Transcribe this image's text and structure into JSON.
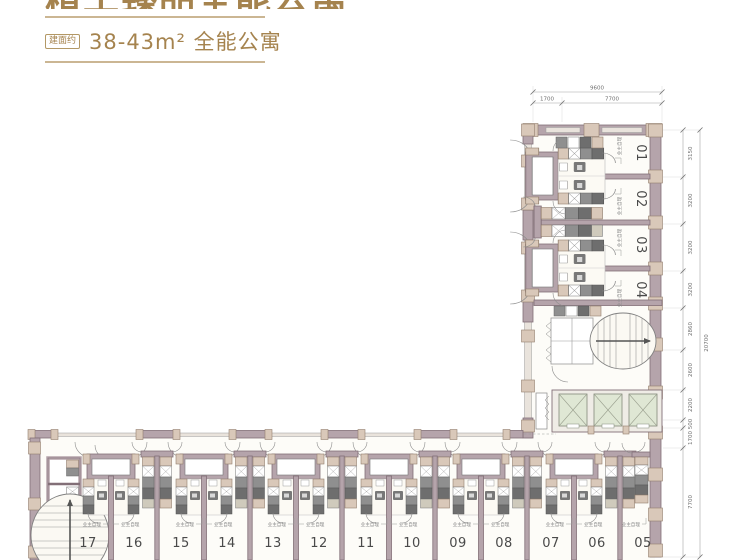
{
  "header": {
    "title_partial": "精工臻品全能公寓",
    "area_badge": "建面约",
    "area_line": "38-43m² 全能公寓"
  },
  "plan": {
    "owner_note": "业主自理",
    "right_units": [
      "01",
      "02",
      "03",
      "04"
    ],
    "bottom_units": [
      "17",
      "16",
      "15",
      "14",
      "13",
      "12",
      "11",
      "10",
      "09",
      "08",
      "07",
      "06",
      "05"
    ],
    "dims": {
      "top_total": "9600",
      "top_segments": [
        "1700",
        "7700"
      ],
      "right_total": "20700",
      "right_segments": [
        "3150",
        "3200",
        "3200",
        "3200",
        "2860",
        "2600",
        "2200",
        "500",
        "1700",
        "7700"
      ]
    }
  }
}
